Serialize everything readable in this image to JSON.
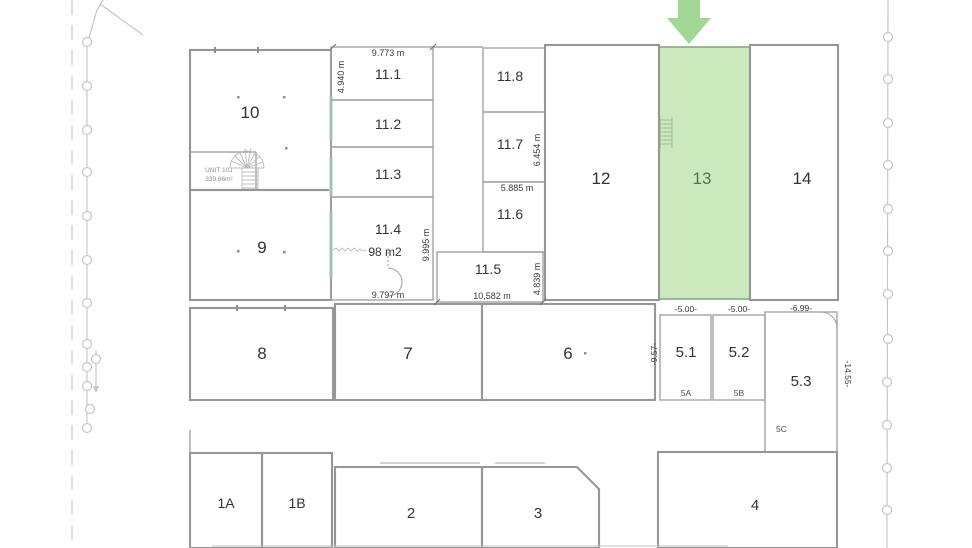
{
  "plan": {
    "highlighted_unit_label": "13",
    "colors": {
      "highlight_fill": "#cbe9bd",
      "highlight_stroke": "#8aa982",
      "highlight_label": "#55705a",
      "arrow_green": "#a2d795",
      "wall_accent_teal": "#c4e8e6",
      "wall_gray": "#969696",
      "dimension_text": "#383838"
    }
  },
  "rooms": {
    "r10": "10",
    "r9": "9",
    "r8": "8",
    "r7": "7",
    "r6": "6",
    "r11_1": "11.1",
    "r11_2": "11.2",
    "r11_3": "11.3",
    "r11_4": "11.4",
    "r11_5": "11.5",
    "r11_6": "11.6",
    "r11_7": "11.7",
    "r11_8": "11.8",
    "r12": "12",
    "r13": "13",
    "r14": "14",
    "r5_1": "5.1",
    "r5_2": "5.2",
    "r5_3": "5.3",
    "r5a": "5A",
    "r5b": "5B",
    "r5c": "5C",
    "r1a": "1A",
    "r1b": "1B",
    "r2": "2",
    "r3": "3",
    "r4": "4"
  },
  "annotations": {
    "unit101_name": "UNIT 101",
    "unit101_area": "339.66m²",
    "area_11_4": "98 m2"
  },
  "dimensions": {
    "top_width_11_1": "9.773 m",
    "height_11_1": "4.940 m",
    "width_11_4": "9.797 m",
    "height_11_col": "9.995 m",
    "height_11_7": "6.454 m",
    "width_11_6": "5.885 m",
    "width_11_5": "10,582 m",
    "height_11_5": "4.839 m",
    "width_5_1": "-5.00-",
    "width_5_2": "-5.00-",
    "width_5_3": "-6.99-",
    "height_5_1": "-9.57-",
    "height_5_3": "-14.55-"
  }
}
